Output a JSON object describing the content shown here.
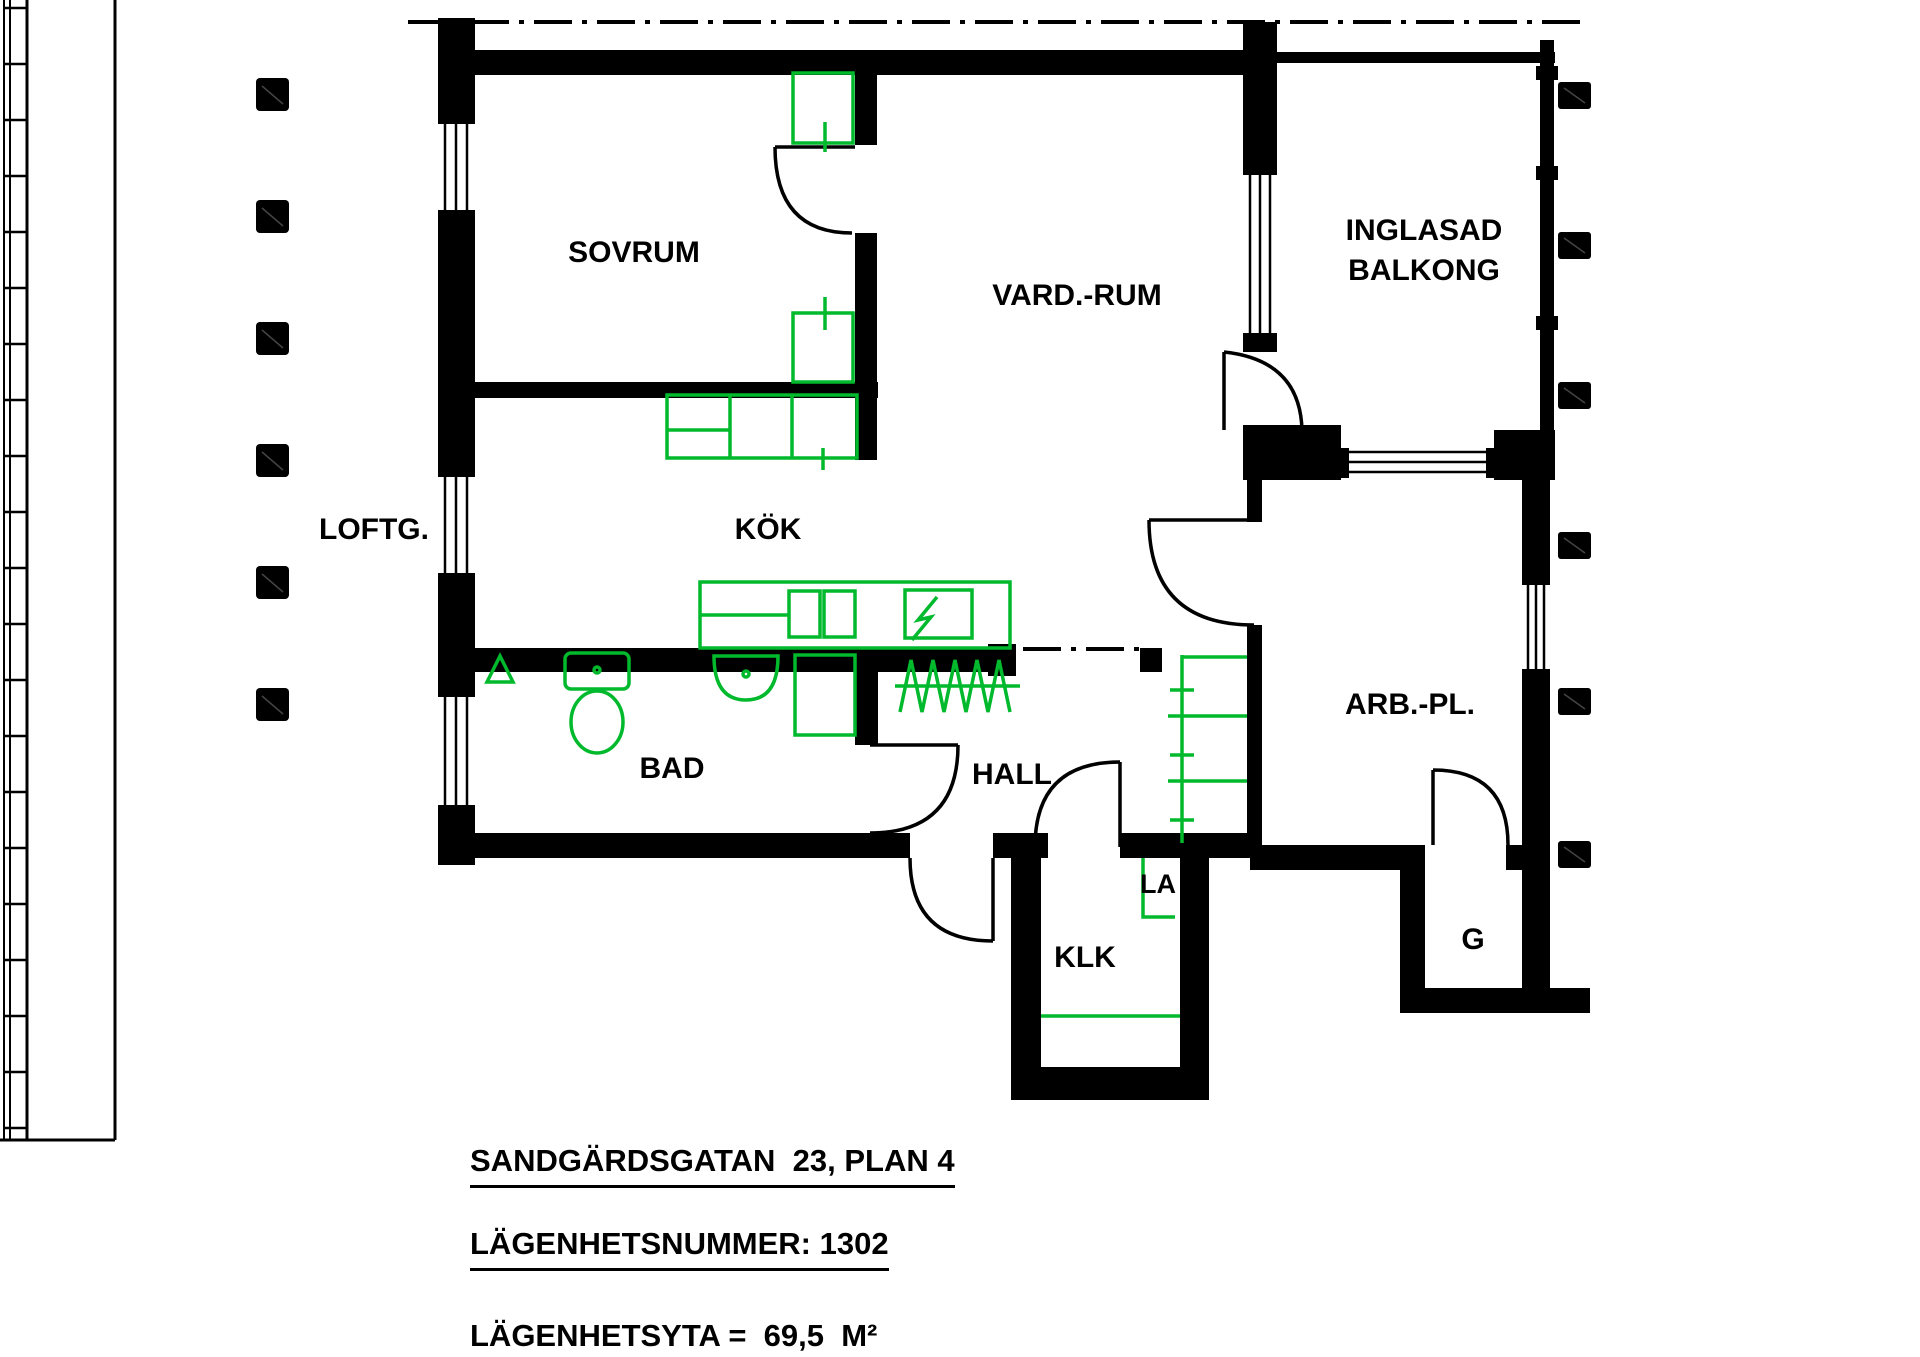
{
  "drawing": {
    "rooms": {
      "sovrum": "SOVRUM",
      "vardagsrum": "VARD.-RUM",
      "balkong_line1": "INGLASAD",
      "balkong_line2": "BALKONG",
      "loftgang": "LOFTG.",
      "kok": "KÖK",
      "bad": "BAD",
      "hall": "HALL",
      "klk": "KLK",
      "la": "LA",
      "garderob": "G",
      "arbetsplats": "ARB.-PL."
    },
    "titles": {
      "address": "SANDGÄRDSGATAN  23, PLAN 4",
      "apartment_number": "LÄGENHETSNUMMER: 1302",
      "area": "LÄGENHETSYTA =  69,5  M²"
    },
    "colors": {
      "walls": "#000000",
      "fixtures": "#00b92c",
      "background": "#ffffff"
    }
  }
}
